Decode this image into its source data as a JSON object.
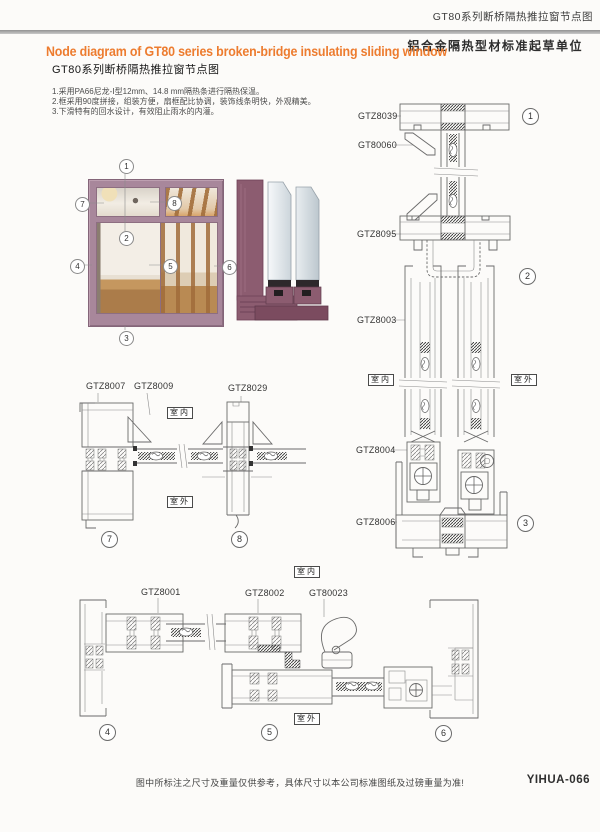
{
  "header": {
    "doc_title": "GT80系列断桥隔热推拉窗节点图",
    "org_subtitle": "铝合金隔热型材标准起草单位",
    "title_en": "Node diagram of GT80 series broken-bridge insulating sliding window",
    "title_zh": "GT80系列断桥隔热推拉窗节点图"
  },
  "notes": {
    "line1": "1.采用PA66尼龙-Ⅰ型12mm、14.8 mm隔热条进行隔热保温。",
    "line2": "2.框采用90度拼接，组装方便，扇框配比协调，装饰线条明快，外观精美。",
    "line3": "3.下滑特有的回水设计，有效阻止雨水的内灌。"
  },
  "photo": {
    "callouts": [
      "1",
      "2",
      "3",
      "4",
      "5",
      "6",
      "7",
      "8"
    ]
  },
  "sections": {
    "right": {
      "labels": [
        "GTZ8039",
        "GT80060",
        "GTZ8095",
        "GTZ8003",
        "GTZ8004",
        "GTZ8006"
      ],
      "nodes": [
        "1",
        "2",
        "3"
      ],
      "indoor": "室内",
      "outdoor": "室外"
    },
    "mid": {
      "labels": [
        "GTZ8007",
        "GTZ8009",
        "GTZ8029"
      ],
      "nodes": [
        "7",
        "8"
      ],
      "indoor": "室内",
      "outdoor": "室外"
    },
    "bottom": {
      "labels": [
        "GTZ8001",
        "GTZ8002",
        "GT80023"
      ],
      "nodes": [
        "4",
        "5",
        "6"
      ],
      "indoor": "室内",
      "outdoor": "室外"
    }
  },
  "footer": {
    "note": "图中所标注之尺寸及重量仅供参考，具体尺寸以本公司标准图纸及过磅重量为准!",
    "page_code": "YIHUA-066"
  },
  "colors": {
    "accent_orange": "#ed7c2f",
    "frame_mauve": "#a8879b",
    "render_purple": "#8c5c70",
    "line_grey": "#6a6a6a"
  }
}
